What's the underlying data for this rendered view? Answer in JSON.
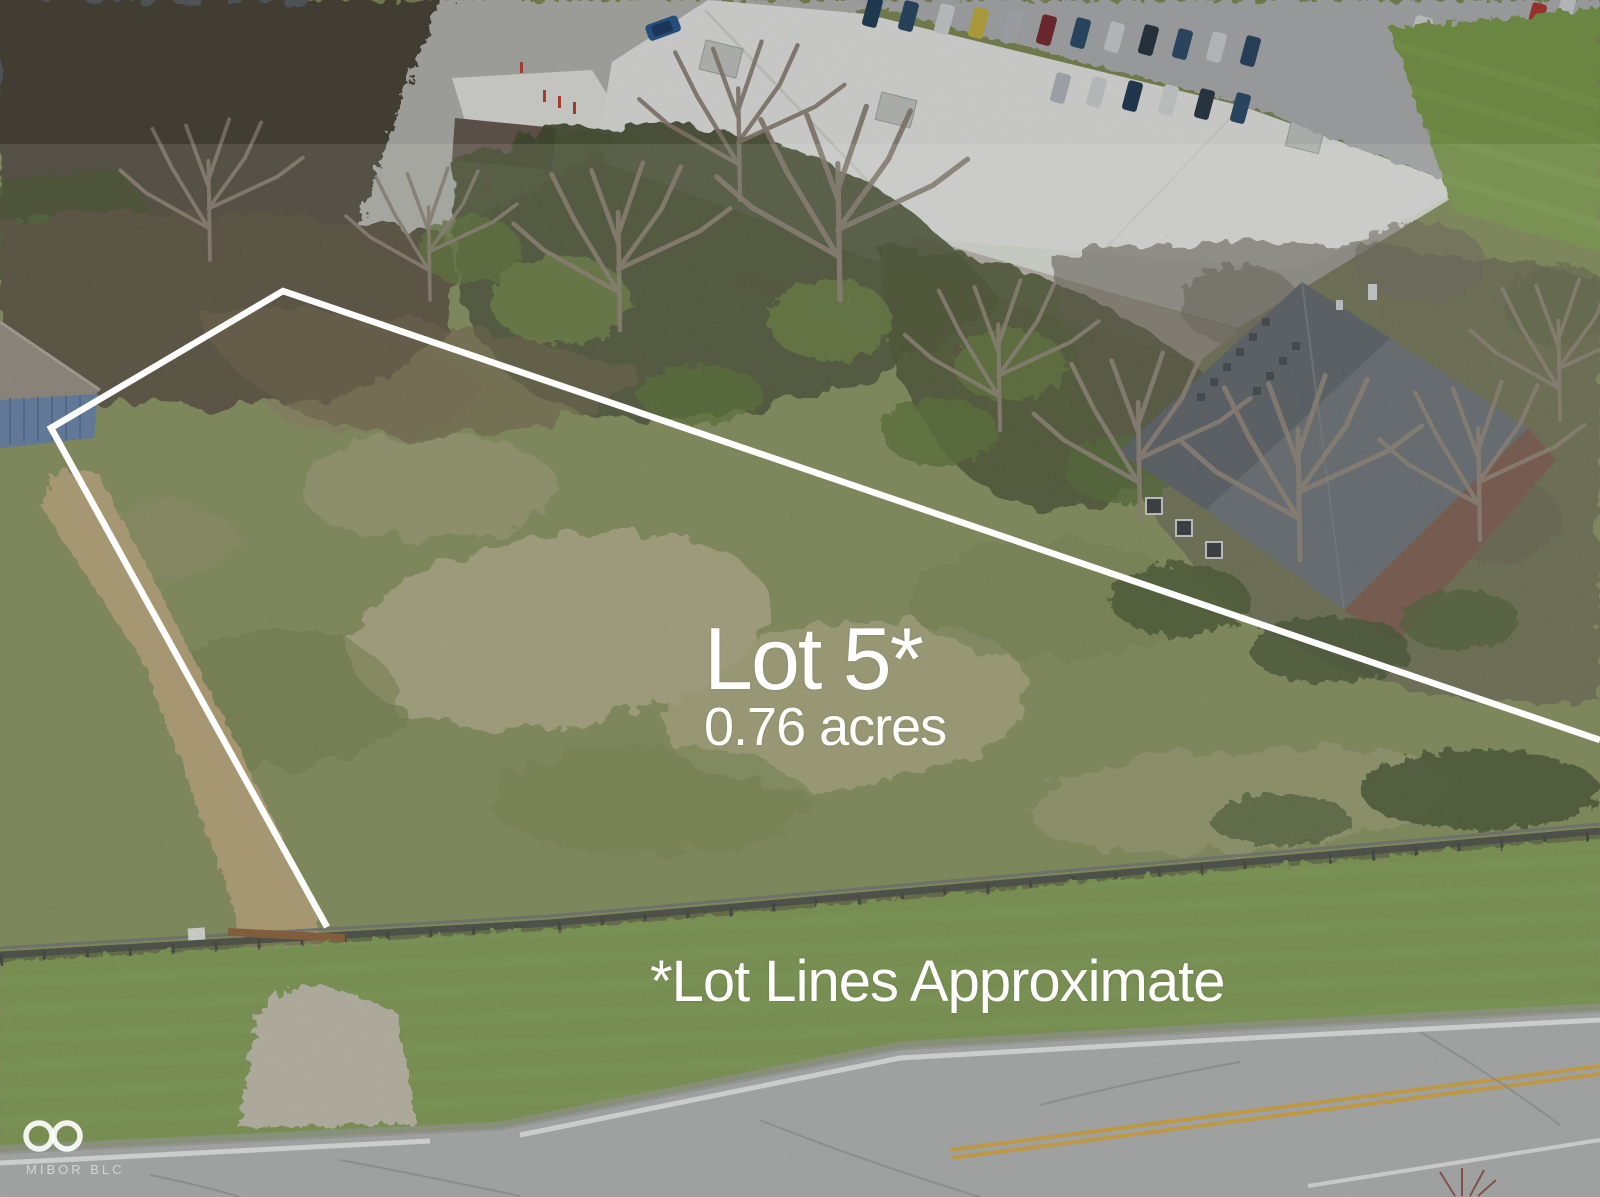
{
  "overlay": {
    "lot_label": "Lot 5*",
    "lot_area": "0.76 acres",
    "disclaimer": "*Lot Lines Approximate",
    "boundary_points": "327,927 51,428 283,291 1600,740",
    "line_color": "#ffffff"
  },
  "watermark": {
    "brand": "MIBOR BLC",
    "icon": "infinity-icon"
  },
  "scene": {
    "building_sign": "XTRA",
    "palette": {
      "field_grass": "#85905a",
      "lawn_grass": "#7c9a4e",
      "dry_grass": "#b7b28c",
      "tree_canopy": "#4d5438",
      "road_asphalt": "#b2b3b5",
      "warehouse_roof": "#ecedea",
      "house_roof": "#596066",
      "siding_blue": "#5f7fa8",
      "center_line_yellow": "#d9a93e",
      "overlay_white": "#ffffff"
    }
  }
}
